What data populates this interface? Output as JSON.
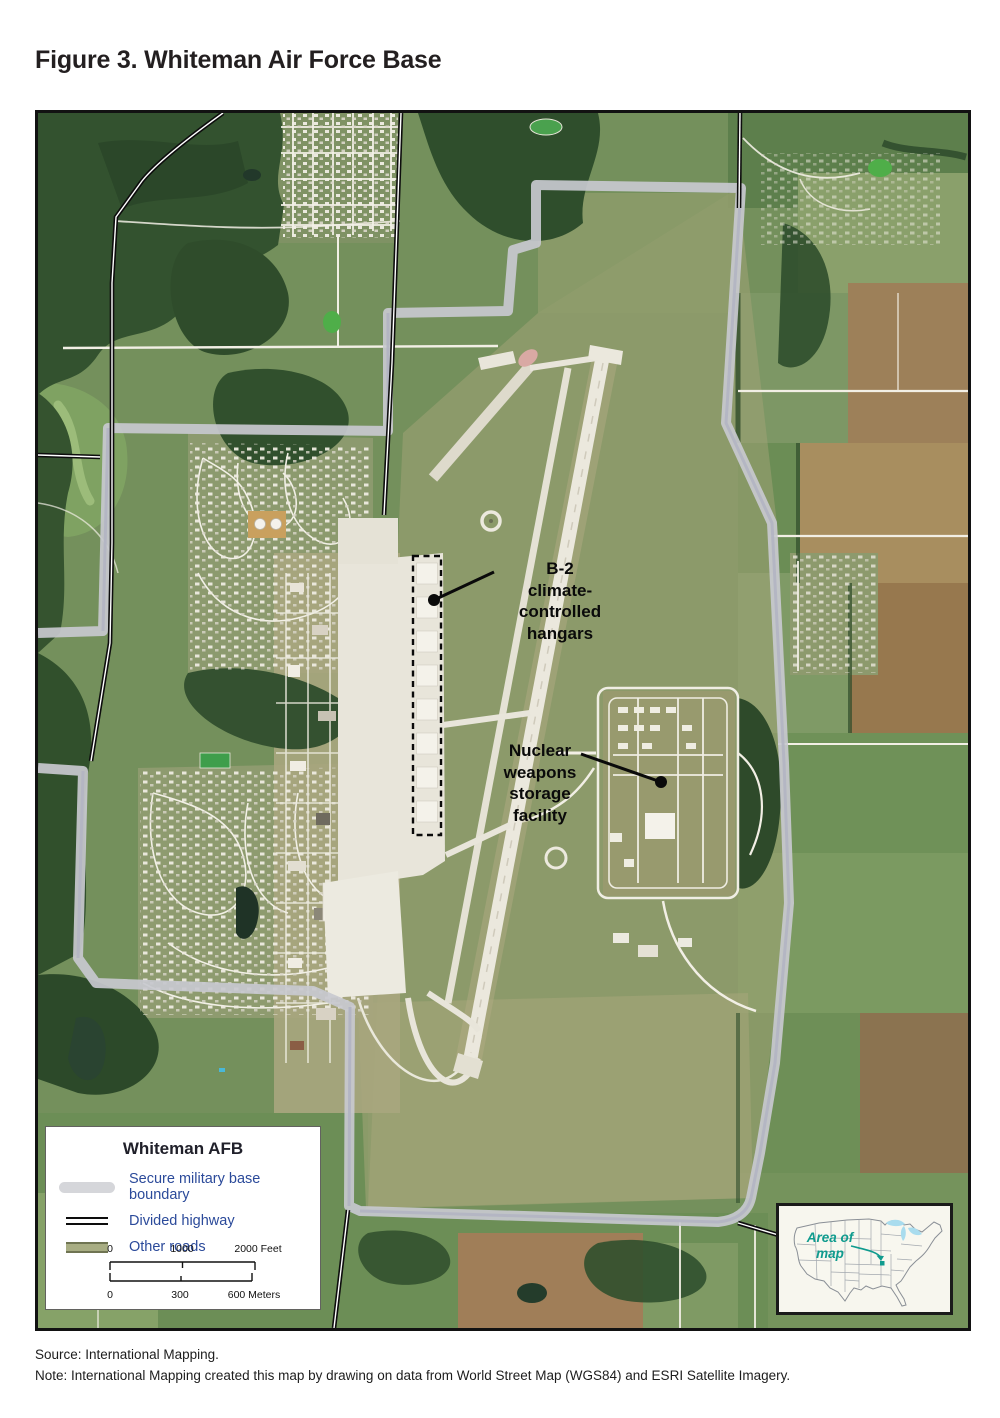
{
  "figure_title": "Figure 3. Whiteman Air Force Base",
  "annotations": {
    "b2_hangars": {
      "label": "B-2\nclimate-\ncontrolled\nhangars"
    },
    "nuclear_storage": {
      "label": "Nuclear\nweapons\nstorage\nfacility"
    }
  },
  "legend": {
    "title": "Whiteman AFB",
    "items": [
      {
        "label": "Secure military base boundary",
        "swatch_color": "#d5d6da"
      },
      {
        "label": "Divided highway",
        "swatch_color": "#0d0d0d"
      },
      {
        "label": "Other roads",
        "swatch_color": "#a8ad83"
      }
    ],
    "scale_feet": {
      "t0": "0",
      "t1": "1000",
      "t2": "2000 Feet"
    },
    "scale_meters": {
      "t0": "0",
      "t1": "300",
      "t2": "600 Meters"
    }
  },
  "inset": {
    "label": "Area of\nmap"
  },
  "footer": {
    "source": "Source: International Mapping.",
    "note": "Note: International Mapping created this map by drawing on data from World Street Map (WGS84) and ESRI Satellite Imagery."
  },
  "colors": {
    "legend_text": "#2b4a9a",
    "boundary_gray": "#c8c9cf",
    "divided_highway": "#0d0d0d",
    "other_roads": "#a8ad83",
    "inset_accent": "#0f9b8e"
  }
}
